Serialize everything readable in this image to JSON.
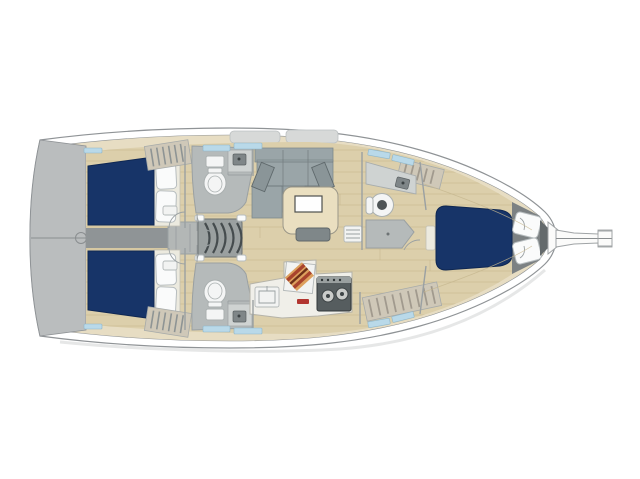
{
  "figure": {
    "kind": "sailboat-interior-floor-plan",
    "orientation": "bow-right"
  },
  "colors": {
    "background": "#ffffff",
    "hull_stroke": "#8f9396",
    "deck": "#e7ddc3",
    "hatch_gray": "#d7d9d8",
    "transom": "#babdbe",
    "floor": "#dccfab",
    "plank": "#c6b78f",
    "corridor": "#8f9496",
    "engine_box": "#b3b7b6",
    "stairs": "#9aa0a0",
    "stair_line": "#454c4e",
    "navy": "#173468",
    "navy_edge": "#0f2752",
    "berth_base": "#eceadf",
    "pillow": "#fafbfb",
    "pillow_stroke": "#b7bdbf",
    "wall": "#9aa0a2",
    "head_floor": "#b5baba",
    "fixture": "#f4f5f5",
    "fixture_stroke": "#aab0b0",
    "counter": "#cfd3d2",
    "sink_dark": "#7f8688",
    "settee": "#9aa5a8",
    "settee_dark": "#8a9598",
    "cushion_edge": "#5f696c",
    "table": "#eadfc0",
    "table_edge": "#9b9788",
    "bench": "#7f8789",
    "unit_white": "#f2f3f2",
    "stove": "#565d5f",
    "stove_edge": "#32383a",
    "burner": "#caccca",
    "board_red": "#a8432d",
    "board_tan": "#dda05e",
    "board_dark": "#6e3018",
    "red_accent": "#b23530",
    "slat_bg": "#cfc8b8",
    "slat_line": "#a19a8e",
    "window": "#b9d9e9",
    "headboard": "#7c8183",
    "anchor": "#646a6c",
    "bowsprit": "#fbfbfa",
    "shadow": "#dcdddd"
  }
}
